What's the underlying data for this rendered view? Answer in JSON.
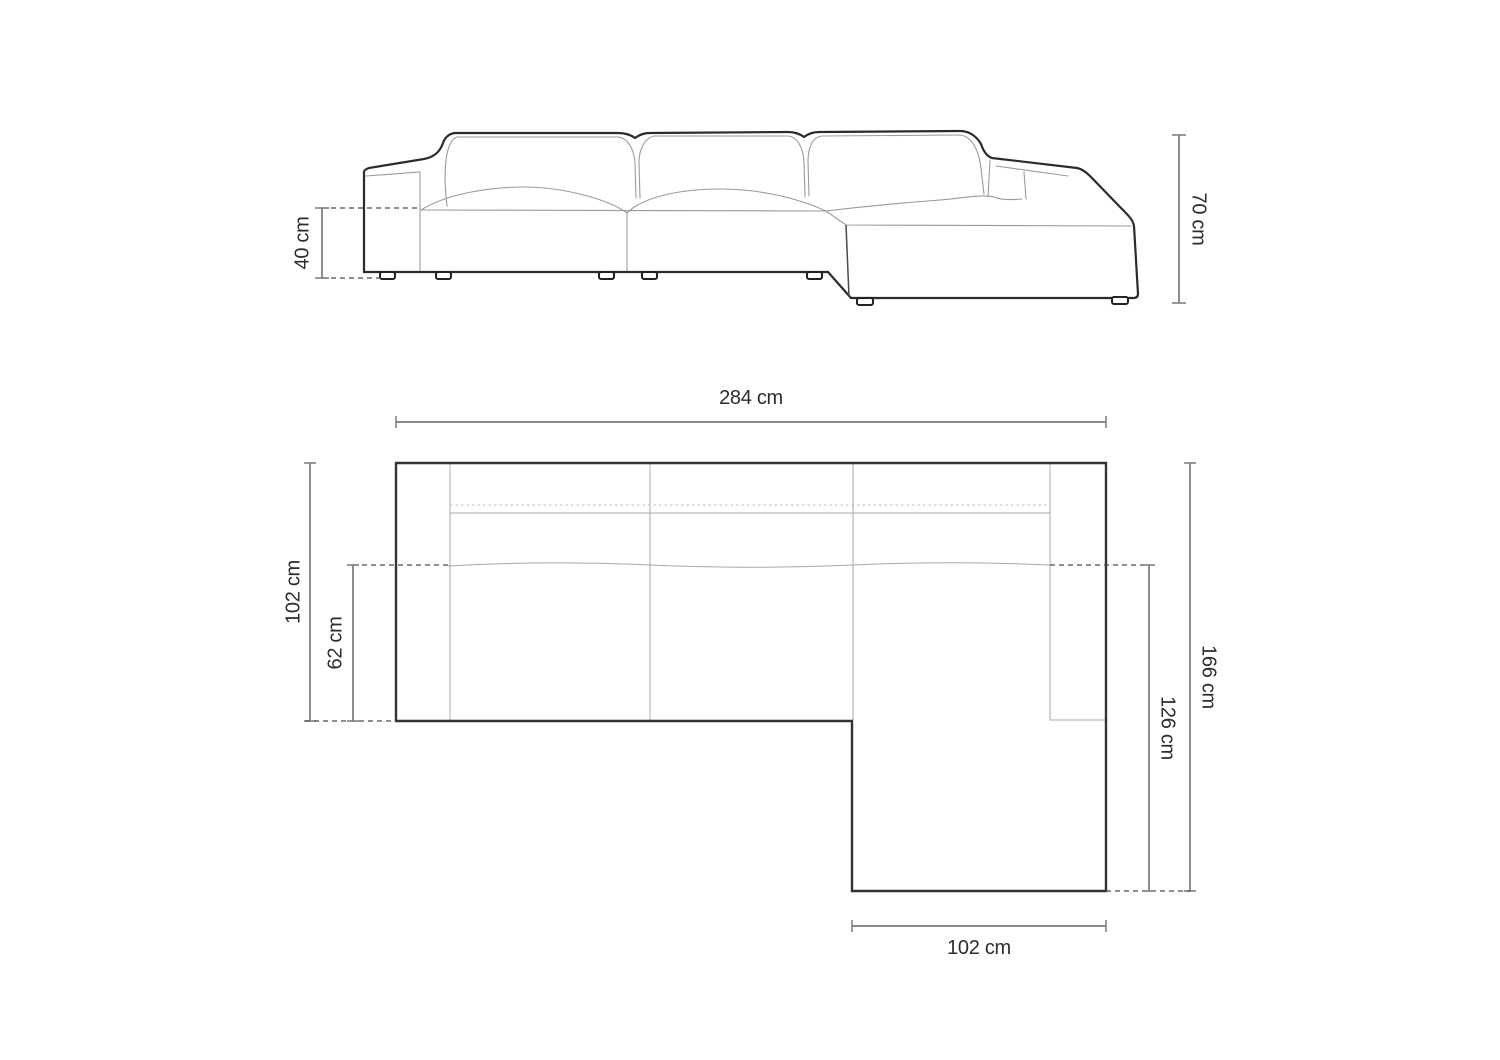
{
  "page": {
    "background": "#ffffff",
    "description": "sofa-dimension-diagram"
  },
  "style": {
    "outline_color": "#2b2b2b",
    "thin_line_color": "#9a9a9a",
    "dimension_line_color": "#7a7a7a",
    "text_color": "#2d2d2d"
  },
  "front_view": {
    "name": "front-elevation",
    "dimensions": {
      "seat_height": {
        "label": "40 cm",
        "value": 40,
        "unit": "cm",
        "orientation": "vertical-left"
      },
      "overall_height": {
        "label": "70 cm",
        "value": 70,
        "unit": "cm",
        "orientation": "vertical-right"
      }
    }
  },
  "plan_view": {
    "name": "top-down-plan",
    "dimensions": {
      "overall_width": {
        "label": "284 cm",
        "value": 284,
        "unit": "cm",
        "orientation": "horizontal-top"
      },
      "sofa_depth": {
        "label": "102 cm",
        "value": 102,
        "unit": "cm",
        "orientation": "vertical-left"
      },
      "seat_depth": {
        "label": "62 cm",
        "value": 62,
        "unit": "cm",
        "orientation": "vertical-left-inner"
      },
      "overall_depth": {
        "label": "166 cm",
        "value": 166,
        "unit": "cm",
        "orientation": "vertical-right"
      },
      "chaise_depth": {
        "label": "126 cm",
        "value": 126,
        "unit": "cm",
        "orientation": "vertical-right-inner"
      },
      "chaise_width": {
        "label": "102 cm",
        "value": 102,
        "unit": "cm",
        "orientation": "horizontal-bottom"
      }
    }
  }
}
